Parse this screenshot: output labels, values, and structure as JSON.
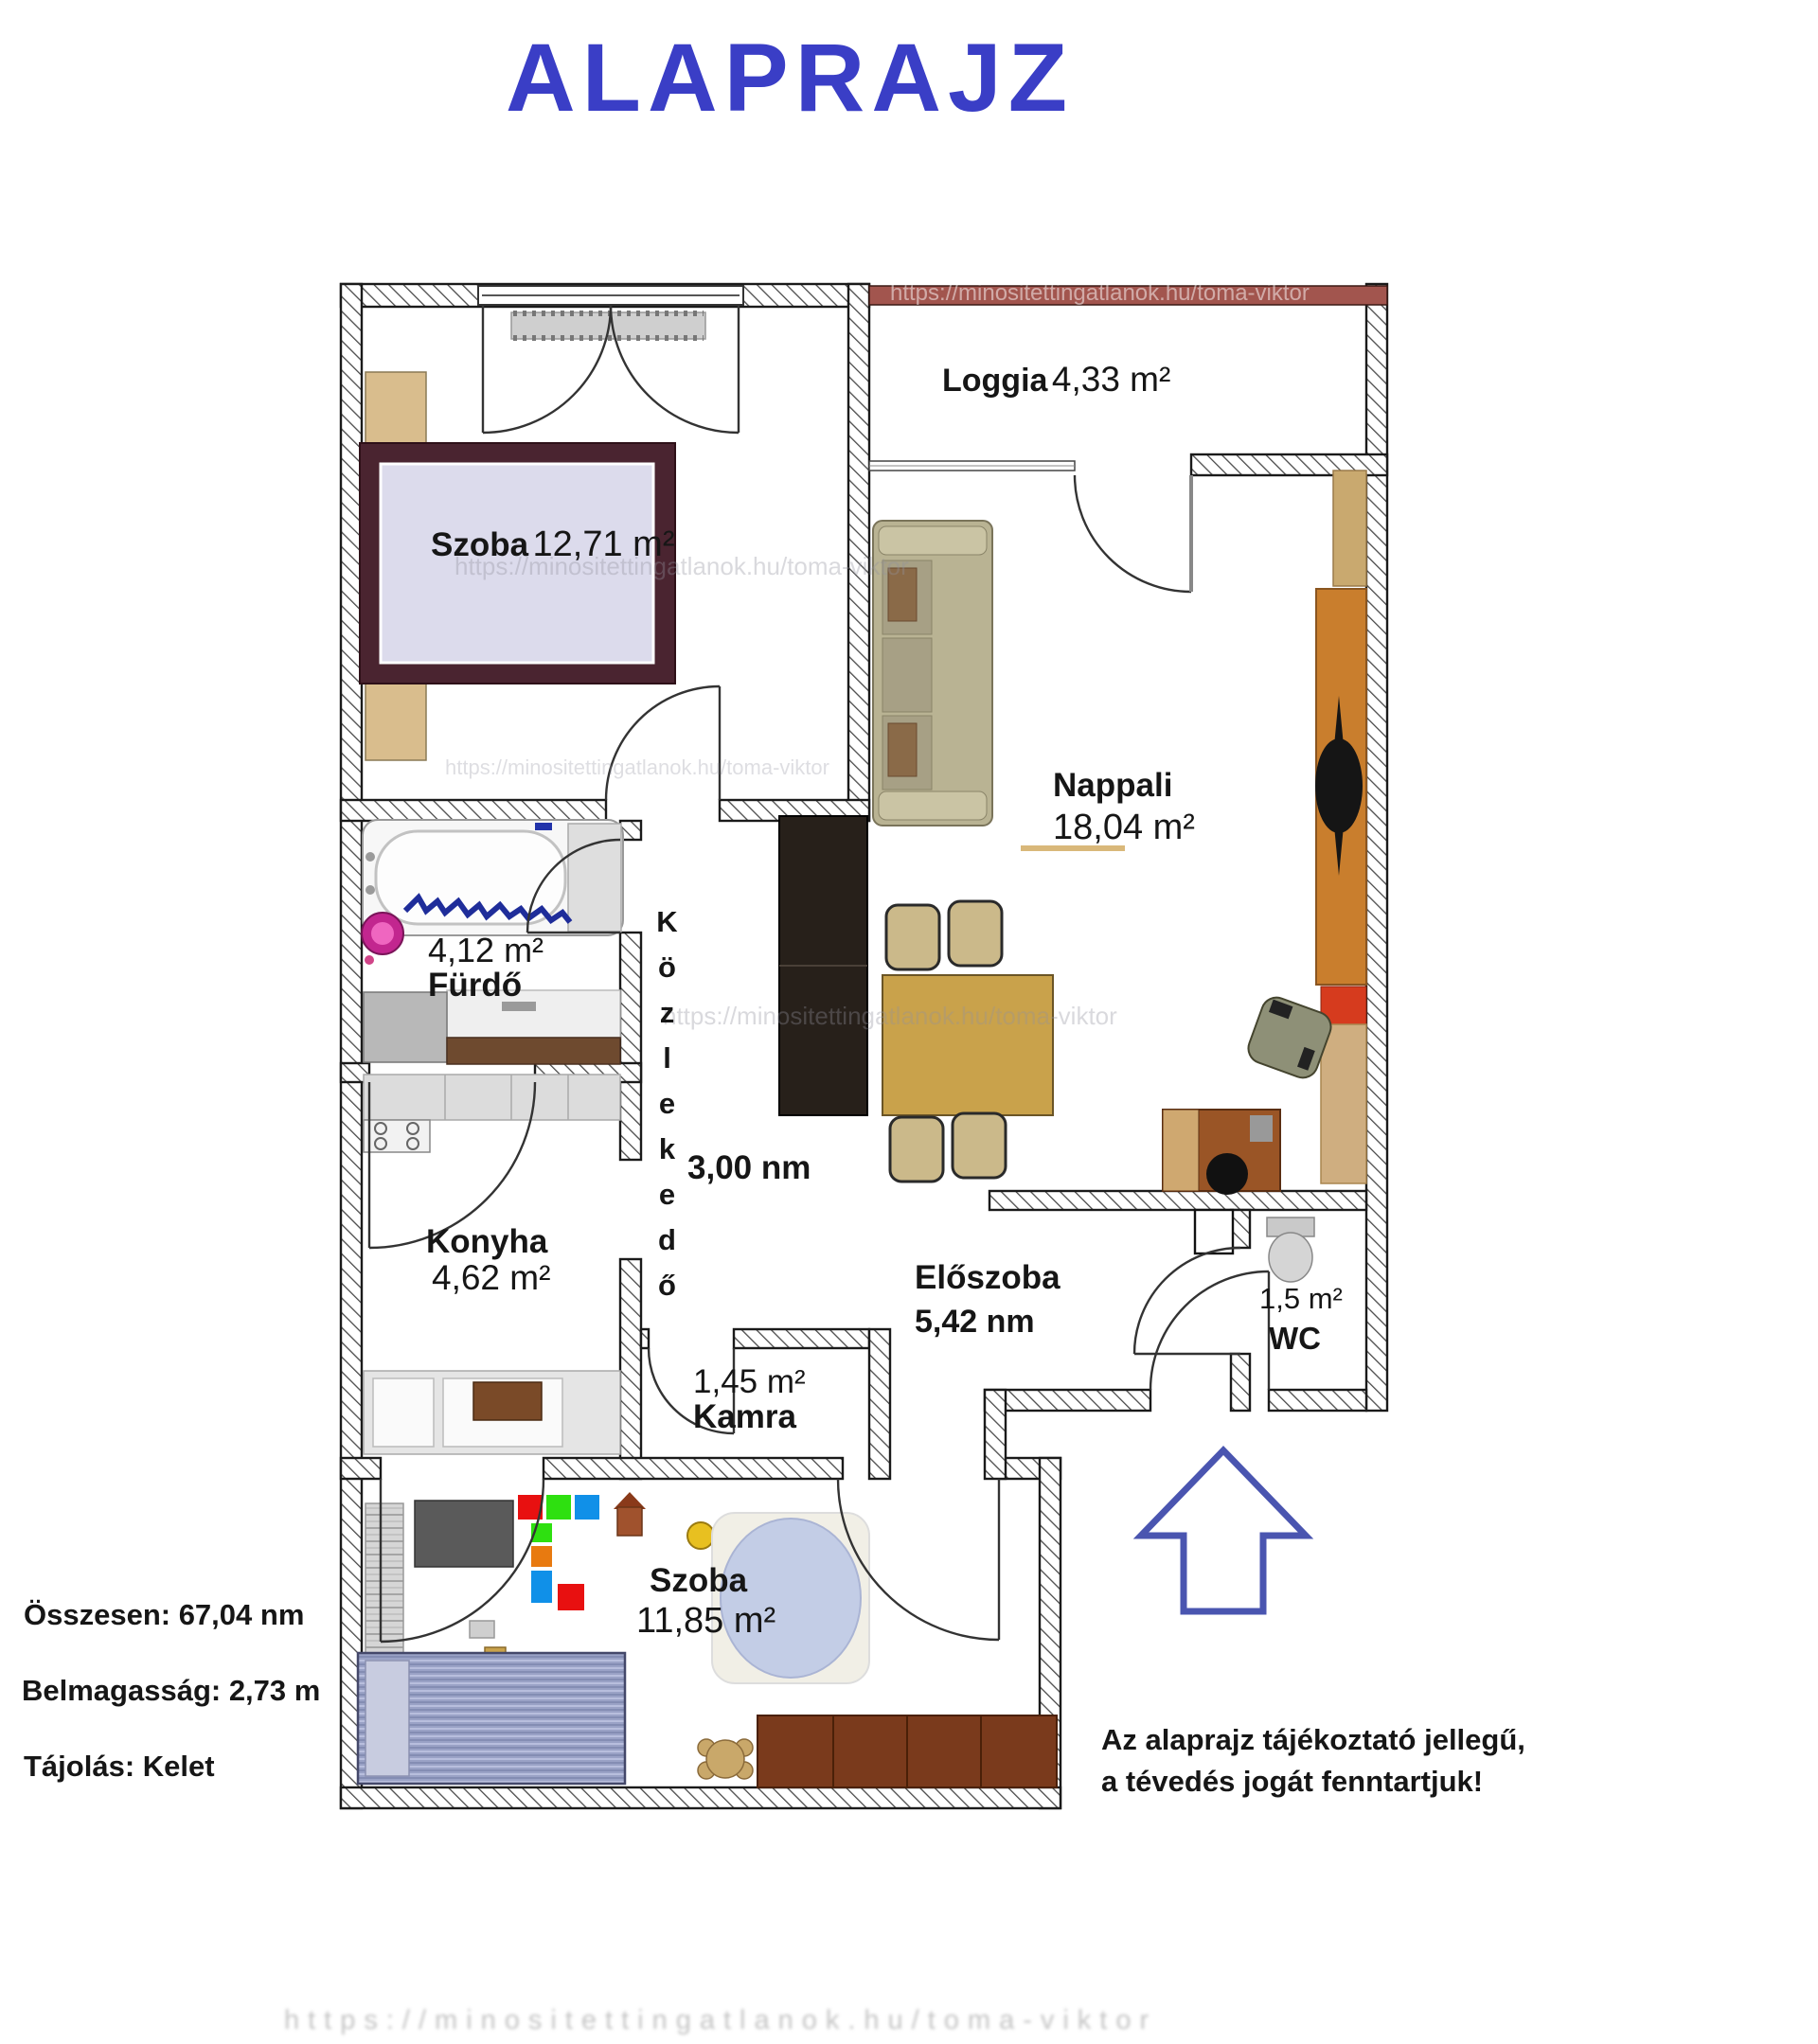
{
  "title": "ALAPRAJZ",
  "watermark": "https://minositettingatlanok.hu/toma-viktor",
  "rooms": {
    "szoba1": {
      "name": "Szoba",
      "area": "12,71 m²"
    },
    "loggia": {
      "name": "Loggia",
      "area": "4,33 m²"
    },
    "nappali": {
      "name": "Nappali",
      "area": "18,04 m²"
    },
    "furdo": {
      "name": "Fürdő",
      "area": "4,12 m²"
    },
    "kozlekedo": {
      "name": "Közlekedő",
      "area": "3,00 nm"
    },
    "konyha": {
      "name": "Konyha",
      "area": "4,62 m²"
    },
    "eloszoba": {
      "name": "Előszoba",
      "area": "5,42 nm"
    },
    "kamra": {
      "name": "Kamra",
      "area": "1,45 m²"
    },
    "wc": {
      "name": "WC",
      "area": "1,5 m²"
    },
    "szoba2": {
      "name": "Szoba",
      "area": "11,85 m²"
    }
  },
  "info": {
    "total": "Összesen: 67,04 nm",
    "height": "Belmagasság: 2,73 m",
    "orientation": "Tájolás: Kelet"
  },
  "disclaimer": {
    "line1": "Az alaprajz tájékoztató jellegű,",
    "line2": "a tévedés jogát fenntartjuk!"
  },
  "colors": {
    "title_blue": "#3a3ec6",
    "arrow_blue": "#4a55b0",
    "railing_brown": "#a2554e"
  }
}
